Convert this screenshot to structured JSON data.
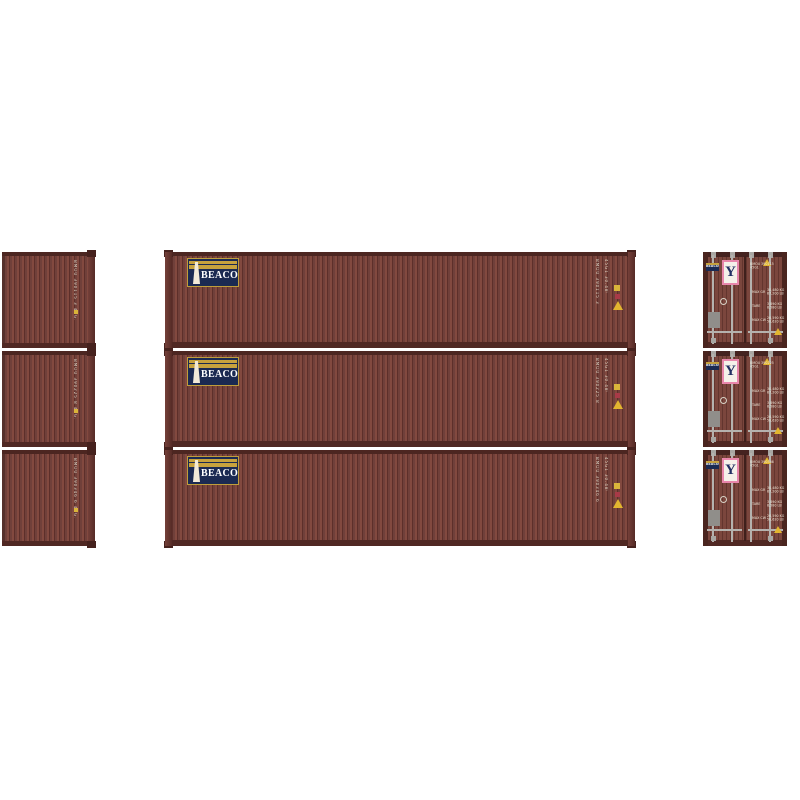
{
  "scene": {
    "description": "Product photo: three brown BEACON 40-ft intermodal containers shown as a stack of three side views (center), three cropped back views (left) and three door-end views (right) on a white background"
  },
  "colors": {
    "body": "#70403a",
    "body_light": "#82493f",
    "body_dark": "#5d2f2a",
    "rail": "#4c2621",
    "logo_navy": "#1b2a52",
    "logo_gold": "#c7a23d",
    "y_navy": "#222f63",
    "y_pink": "#e886ab",
    "hardware_gray": "#b5b2ae",
    "warning_yellow": "#e2b52f",
    "marking_text": "#dcd5c6"
  },
  "left_stack": {
    "units": [
      {
        "marking": "BMOU 390115 3 45G1"
      },
      {
        "marking": "BMOU 390225 8 45G1"
      },
      {
        "marking": "BMOU 390346 6 45G1"
      }
    ]
  },
  "center_stack": {
    "units": [
      {
        "logo_text": "BEACON",
        "number_vertical": "BMOU 390115 3",
        "spec_vertical": "45G1 30.480 KG"
      },
      {
        "logo_text": "BEACON",
        "number_vertical": "BMOU 390225 8",
        "spec_vertical": "45G1 30.480 KG"
      },
      {
        "logo_text": "BEACON",
        "number_vertical": "BMOU 390346 6",
        "spec_vertical": "45G1 30.480 KG"
      }
    ]
  },
  "right_stack": {
    "units": [
      {
        "beacon_label": "BEACON",
        "y_mark": "Y",
        "number": "BMOU 390115",
        "type_code": "45G1",
        "weights": [
          {
            "label": "MAX GR",
            "kg": "30,480 KG",
            "lb": "67,200 LB"
          },
          {
            "label": "TARE",
            "kg": "3,890 KG",
            "lb": "8,580 LB"
          },
          {
            "label": "MAX CW",
            "kg": "26,590 KG",
            "lb": "58,620 LB"
          }
        ]
      },
      {
        "beacon_label": "BEACON",
        "y_mark": "Y",
        "number": "BMOU 390225",
        "type_code": "45G1",
        "weights": [
          {
            "label": "MAX GR",
            "kg": "30,480 KG",
            "lb": "67,200 LB"
          },
          {
            "label": "TARE",
            "kg": "3,890 KG",
            "lb": "8,580 LB"
          },
          {
            "label": "MAX CW",
            "kg": "26,590 KG",
            "lb": "58,620 LB"
          }
        ]
      },
      {
        "beacon_label": "BEACON",
        "y_mark": "Y",
        "number": "BMOU 390346",
        "type_code": "45G1",
        "weights": [
          {
            "label": "MAX GR",
            "kg": "30,480 KG",
            "lb": "67,200 LB"
          },
          {
            "label": "TARE",
            "kg": "3,890 KG",
            "lb": "8,580 LB"
          },
          {
            "label": "MAX CW",
            "kg": "26,590 KG",
            "lb": "58,620 LB"
          }
        ]
      }
    ]
  }
}
